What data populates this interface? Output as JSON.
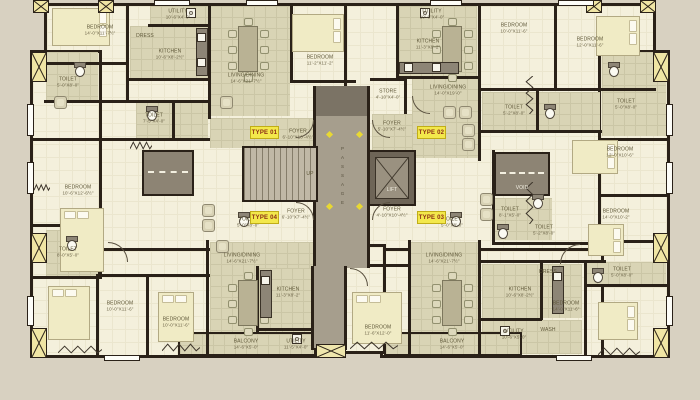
{
  "plan": {
    "types": {
      "t1": "TYPE 01",
      "t2": "TYPE 02",
      "t3": "TYPE 03",
      "t4": "TYPE 04"
    },
    "core": {
      "passage": "PASSAGE",
      "up": "UP",
      "lift": "LIFT",
      "void": "VOID"
    },
    "rooms": {
      "bed_tl": {
        "name": "BEDROOM",
        "dims": "14'-0\"X11'-7½\""
      },
      "toilet_l1": {
        "name": "TOILET",
        "dims": "5'-0\"X8'-0\""
      },
      "utility_tl": {
        "name": "UTILITY",
        "dims": "10'-6\"X4'-0\""
      },
      "kitchen_tl": {
        "name": "KITCHEN",
        "dims": "10'-6\"X8'-2½\""
      },
      "dress_tl": {
        "name": "DRESS",
        "dims": ""
      },
      "livdin_tl": {
        "name": "LIVING/DINING",
        "dims": "14'-6\"X21'-7½\""
      },
      "bed_tc": {
        "name": "BEDROOM",
        "dims": "11'-2\"X11'-2\""
      },
      "toilet_l2": {
        "name": "TOILET",
        "dims": "7'-5\"X4'-0\""
      },
      "bed_l": {
        "name": "BEDROOM",
        "dims": "10'-6\"X12'-6½\""
      },
      "toilet_l3": {
        "name": "TOILET",
        "dims": "8'-0\"X5'-0\""
      },
      "bed_bl1": {
        "name": "BEDROOM",
        "dims": "10'-0\"X11'-6\""
      },
      "bed_bl2": {
        "name": "BEDROOM",
        "dims": "10'-0\"X11'-6\""
      },
      "livdin_bl": {
        "name": "LIVING/DINING",
        "dims": "14'-6\"X21'-7½\""
      },
      "kitchen_bl": {
        "name": "KITCHEN",
        "dims": "11'-3\"X8'-2\""
      },
      "utility_bl": {
        "name": "UTILITY",
        "dims": "11'-5\"X4'-0\""
      },
      "balcony_l": {
        "name": "BALCONY",
        "dims": "14'-6\"X5'-0\""
      },
      "balcony_r": {
        "name": "BALCONY",
        "dims": "14'-6\"X5'-0\""
      },
      "foyer_1": {
        "name": "FOYER",
        "dims": "6'-10\"X10'-4½\""
      },
      "foyer_2": {
        "name": "FOYER",
        "dims": "5'-10\"X7'-4½\""
      },
      "foyer_3": {
        "name": "FOYER",
        "dims": "6'-10\"X7'-4½\""
      },
      "foyer_4": {
        "name": "FOYER",
        "dims": "4'-10\"X10'-4½\""
      },
      "store_r": {
        "name": "STORE",
        "dims": "4'-10\"X4'-0\""
      },
      "utility_tr": {
        "name": "UTILITY",
        "dims": "10'-6\"X4'-0\""
      },
      "kitchen_tr": {
        "name": "KITCHEN",
        "dims": "11'-3\"X8'-2\""
      },
      "livdin_tr": {
        "name": "LIVING/DINING",
        "dims": "14'-0\"X19'-0\""
      },
      "bed_tr1": {
        "name": "BEDROOM",
        "dims": "10'-0\"X11'-6\""
      },
      "bed_tr2": {
        "name": "BEDROOM",
        "dims": "12'-0\"X11'-6\""
      },
      "toilet_r1": {
        "name": "TOILET",
        "dims": "5'-2\"X8'-0\""
      },
      "toilet_r2": {
        "name": "TOILET",
        "dims": "5'-0\"X8'-0\""
      },
      "bed_r1": {
        "name": "BEDROOM",
        "dims": "12'-0\"X10'-6\""
      },
      "bed_r2": {
        "name": "BEDROOM",
        "dims": "14'-0\"X10'-2\""
      },
      "toilet_r3": {
        "name": "TOILET",
        "dims": "8'-1\"X5'-0\""
      },
      "toilet_r4": {
        "name": "TOILET",
        "dims": "5'-2\"X8'-0\""
      },
      "bed_bc": {
        "name": "BEDROOM",
        "dims": "11'-6\"X12'-0\""
      },
      "livdin_br": {
        "name": "LIVING/DINING",
        "dims": "14'-6\"X21'-7½\""
      },
      "kitchen_br": {
        "name": "KITCHEN",
        "dims": "10'-6\"X8'-2½\""
      },
      "utility_br": {
        "name": "UTILITY",
        "dims": "10'-6\"X5'-0\""
      },
      "wash_br": {
        "name": "WASH",
        "dims": ""
      },
      "dress_br": {
        "name": "DRESS",
        "dims": ""
      },
      "bed_br": {
        "name": "BEDROOM",
        "dims": "14'-0\"X11'-6\""
      },
      "toilet_br": {
        "name": "TOILET",
        "dims": "5'-0\"X8'-0\""
      },
      "toilet_c1": {
        "name": "TOILET",
        "dims": "5'-0\"X8'-0\""
      },
      "toilet_c2": {
        "name": "TOILET",
        "dims": "5'-0\"X8'-0\""
      }
    }
  },
  "colors": {
    "background": "#d8d1c1",
    "wall": "#2a2118",
    "room_floor": "#f4f0dc",
    "tile_floor": "#d9d4b5",
    "passage": "#a69e8d",
    "type_label_bg": "#f3e84b",
    "type_label_text": "#8a2c16",
    "column": "#f0e5a4",
    "bed": "#f0ebc5",
    "marker": "#e8d832"
  }
}
